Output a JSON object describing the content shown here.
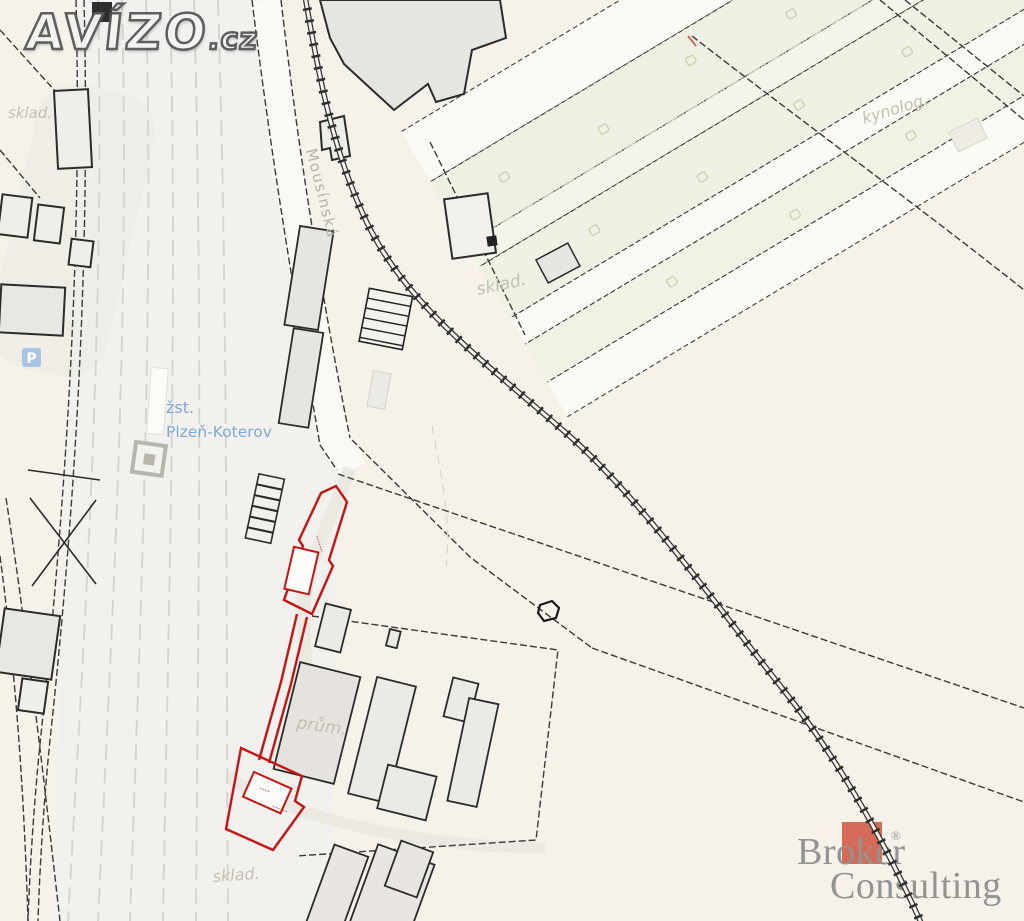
{
  "watermark": {
    "brand": "AVÍZO",
    "tld": ".cz"
  },
  "map_labels": {
    "station_abbr": "žst.",
    "station_name": "Plzeň-Koterov",
    "street": "Mousínská",
    "sklad_top": "sklad.",
    "sklad_center": "sklad.",
    "sklad_bottom": "sklad.",
    "kynolog": "kynolog.",
    "prum": "prům.",
    "parking": "P"
  },
  "logo": {
    "word1": "Broker",
    "word2": "Consulting",
    "registered": "®"
  },
  "colors": {
    "background": "#f6f2ea",
    "parcel_highlight_red": "#c41414",
    "station_blue": "#7fa8d8",
    "area_label_gray": "#c3bfb5",
    "logo_red": "#d4604f",
    "logo_gray": "#8c8c8c",
    "field_green": "#edf0e2",
    "building_gray": "#e7e5e0"
  }
}
